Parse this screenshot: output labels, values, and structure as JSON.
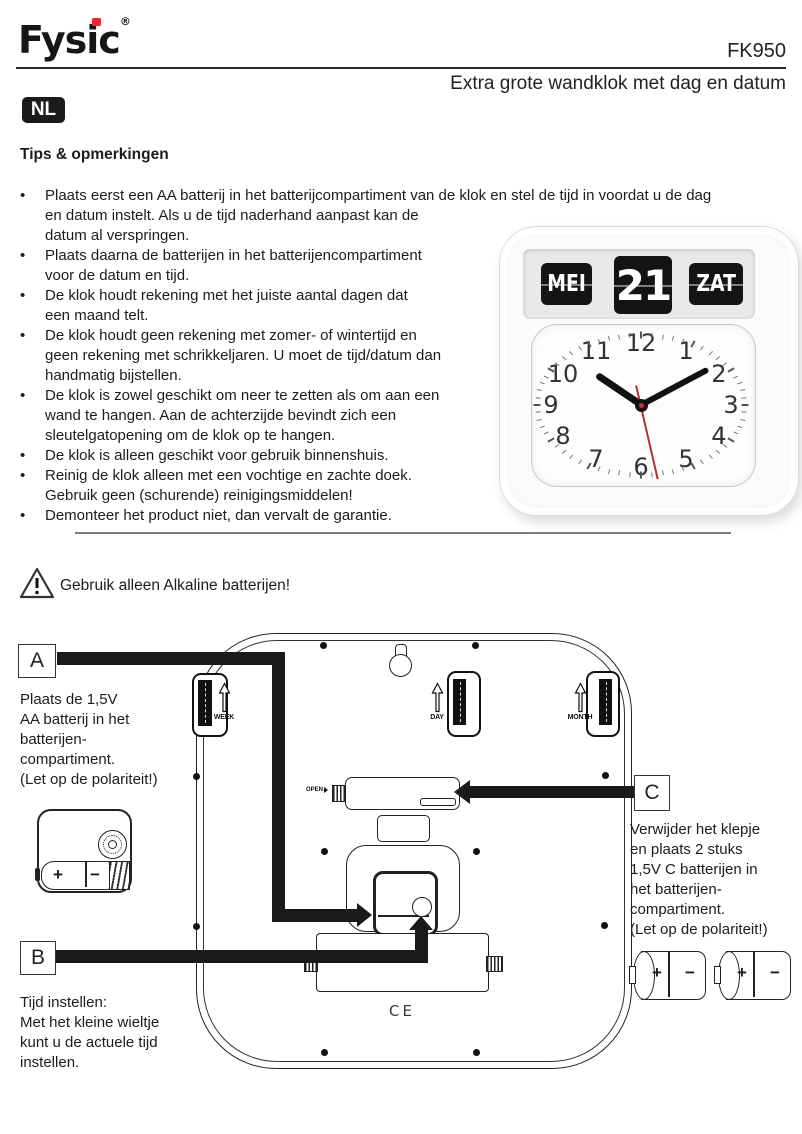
{
  "header": {
    "brand": "Fysic",
    "registered": "®",
    "model": "FK950",
    "title": "Extra grote wandklok met dag en datum",
    "language_badge": "NL"
  },
  "tips": {
    "heading": "Tips & opmerkingen",
    "bullet_char": "•",
    "bullets": [
      [
        "Plaats eerst een AA batterij in het batterijcompartiment van de klok en stel de tijd in voordat u de dag",
        "en datum instelt. Als u de tijd naderhand aanpast kan de",
        "datum al verspringen."
      ],
      [
        "Plaats daarna de batterijen in het batterijencompartiment",
        "voor de datum en tijd."
      ],
      [
        "De klok houdt rekening met het juiste aantal dagen dat",
        "een maand telt."
      ],
      [
        "De klok houdt geen rekening met zomer- of wintertijd en",
        "geen rekening met schrikkeljaren. U moet de tijd/datum dan",
        "handmatig bijstellen."
      ],
      [
        "De klok is zowel geschikt om neer te zetten als om aan een",
        "wand te hangen. Aan de achterzijde bevindt zich een",
        "sleutelgatopening om de klok op te hangen."
      ],
      [
        "De klok is alleen geschikt voor gebruik binnenshuis."
      ],
      [
        "Reinig de klok alleen met een vochtige en zachte doek.",
        "Gebruik geen (schurende) reinigingsmiddelen!"
      ],
      [
        "Demonteer het product niet, dan vervalt de garantie."
      ]
    ]
  },
  "clock_photo": {
    "flip_month": "MEI",
    "flip_day": "21",
    "flip_weekday": "ZAT",
    "dial_numbers": [
      "1",
      "2",
      "3",
      "4",
      "5",
      "6",
      "7",
      "8",
      "9",
      "10",
      "11",
      "12"
    ]
  },
  "warning": {
    "text": "Gebruik alleen Alkaline batterijen!"
  },
  "diagram": {
    "labels": {
      "a": "A",
      "b": "B",
      "c": "C"
    },
    "a_note": [
      "Plaats de 1,5V",
      "AA batterij in het",
      "batterijen-",
      "compartiment.",
      "(Let op de polariteit!)"
    ],
    "b_note": [
      "Tijd instellen:",
      "Met het kleine wieltje",
      "kunt u de actuele tijd",
      "instellen."
    ],
    "c_note": [
      "Verwijder het klepje",
      "en plaats 2 stuks",
      "1,5V C batterijen in",
      "het batterijen-",
      "compartiment.",
      "(Let op de polariteit!)"
    ],
    "wheels": {
      "week": "WEEK",
      "day": "DAY",
      "month": "MONTH"
    },
    "open_label": "OPEN",
    "ce_mark": "CE",
    "battery_plus": "+",
    "battery_minus": "−"
  }
}
